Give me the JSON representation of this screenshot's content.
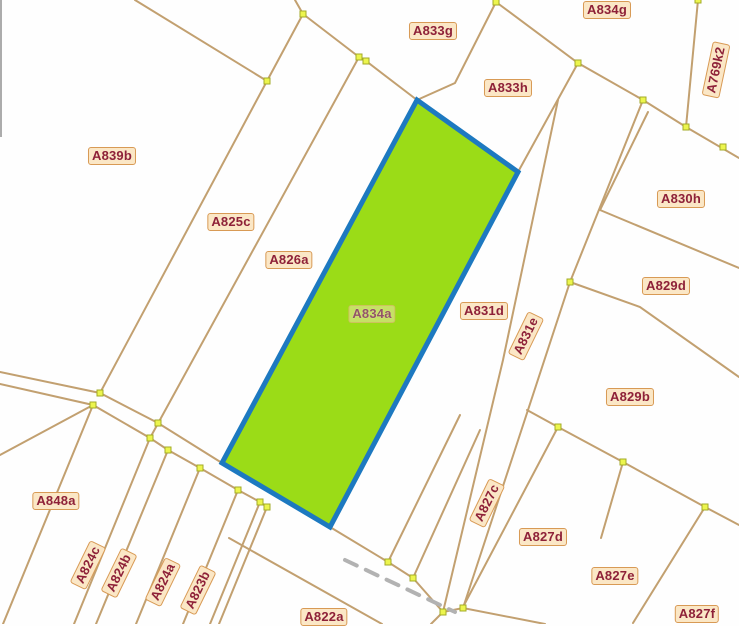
{
  "map": {
    "width": 739,
    "height": 624,
    "background_color": "#fefefe",
    "boundary_line_color": "#c2a070",
    "boundary_line_width": 2,
    "vertex_marker": {
      "fill": "#ecf54d",
      "stroke": "#a3ab28",
      "size": 6
    },
    "label_style": {
      "text_color": "#8e2138",
      "plate_color": "#fbe7c6",
      "plate_border_color": "#d89a55"
    },
    "highlighted_parcel": {
      "label": "A834a",
      "fill_color": "#9bdc17",
      "border_color": "#1d79c0",
      "border_width": 5,
      "points": [
        [
          417,
          100
        ],
        [
          518,
          172
        ],
        [
          330,
          527
        ],
        [
          222,
          463
        ]
      ]
    },
    "edge_artifact": {
      "points": [
        [
          1,
          0
        ],
        [
          1,
          137
        ]
      ],
      "color": "#909090",
      "width": 1.5
    },
    "watermark_dash": {
      "points": [
        [
          345,
          560
        ],
        [
          455,
          612
        ]
      ],
      "color": "#b2b2b2",
      "width": 4,
      "dash": "13 10"
    },
    "boundary_lines": [
      [
        [
          135,
          0
        ],
        [
          267,
          81
        ]
      ],
      [
        [
          295,
          0
        ],
        [
          303,
          14
        ]
      ],
      [
        [
          303,
          14
        ],
        [
          267,
          81
        ]
      ],
      [
        [
          303,
          14
        ],
        [
          359,
          57
        ]
      ],
      [
        [
          267,
          81
        ],
        [
          100,
          393
        ]
      ],
      [
        [
          359,
          57
        ],
        [
          150,
          438
        ]
      ],
      [
        [
          359,
          57
        ],
        [
          366,
          61
        ],
        [
          417,
          100
        ]
      ],
      [
        [
          496,
          2
        ],
        [
          455,
          83
        ],
        [
          417,
          100
        ]
      ],
      [
        [
          496,
          2
        ],
        [
          578,
          63
        ],
        [
          643,
          100
        ],
        [
          686,
          127
        ],
        [
          739,
          158
        ]
      ],
      [
        [
          698,
          0
        ],
        [
          686,
          127
        ]
      ],
      [
        [
          578,
          63
        ],
        [
          518,
          172
        ]
      ],
      [
        [
          558,
          100
        ],
        [
          503,
          360
        ],
        [
          443,
          612
        ]
      ],
      [
        [
          643,
          100
        ],
        [
          570,
          282
        ],
        [
          463,
          608
        ]
      ],
      [
        [
          648,
          112
        ],
        [
          600,
          210
        ]
      ],
      [
        [
          600,
          210
        ],
        [
          739,
          268
        ]
      ],
      [
        [
          570,
          282
        ],
        [
          640,
          307
        ],
        [
          739,
          377
        ]
      ],
      [
        [
          527,
          410
        ],
        [
          558,
          427
        ]
      ],
      [
        [
          558,
          427
        ],
        [
          623,
          462
        ],
        [
          705,
          507
        ],
        [
          739,
          525
        ]
      ],
      [
        [
          623,
          462
        ],
        [
          601,
          538
        ]
      ],
      [
        [
          558,
          427
        ],
        [
          463,
          607
        ]
      ],
      [
        [
          705,
          507
        ],
        [
          633,
          623
        ]
      ],
      [
        [
          0,
          372
        ],
        [
          100,
          393
        ],
        [
          158,
          423
        ],
        [
          222,
          463
        ]
      ],
      [
        [
          330,
          527
        ],
        [
          388,
          562
        ],
        [
          413,
          578
        ],
        [
          443,
          612
        ]
      ],
      [
        [
          443,
          612
        ],
        [
          463,
          608
        ],
        [
          545,
          624
        ]
      ],
      [
        [
          0,
          384
        ],
        [
          93,
          405
        ],
        [
          150,
          438
        ],
        [
          168,
          450
        ],
        [
          200,
          468
        ],
        [
          238,
          490
        ],
        [
          260,
          502
        ],
        [
          267,
          507
        ]
      ],
      [
        [
          229,
          538
        ],
        [
          382,
          624
        ]
      ],
      [
        [
          93,
          405
        ],
        [
          3,
          624
        ]
      ],
      [
        [
          150,
          438
        ],
        [
          74,
          624
        ]
      ],
      [
        [
          168,
          450
        ],
        [
          96,
          624
        ]
      ],
      [
        [
          200,
          468
        ],
        [
          136,
          624
        ]
      ],
      [
        [
          238,
          490
        ],
        [
          183,
          624
        ]
      ],
      [
        [
          260,
          502
        ],
        [
          210,
          624
        ]
      ],
      [
        [
          267,
          507
        ],
        [
          219,
          624
        ]
      ],
      [
        [
          443,
          612
        ],
        [
          431,
          624
        ]
      ],
      [
        [
          0,
          455
        ],
        [
          93,
          405
        ]
      ],
      [
        [
          388,
          562
        ],
        [
          460,
          415
        ]
      ],
      [
        [
          413,
          578
        ],
        [
          480,
          430
        ]
      ]
    ],
    "vertex_markers": [
      [
        303,
        14
      ],
      [
        267,
        81
      ],
      [
        359,
        57
      ],
      [
        366,
        61
      ],
      [
        496,
        2
      ],
      [
        578,
        63
      ],
      [
        643,
        100
      ],
      [
        686,
        127
      ],
      [
        698,
        0
      ],
      [
        723,
        147
      ],
      [
        570,
        282
      ],
      [
        558,
        427
      ],
      [
        623,
        462
      ],
      [
        705,
        507
      ],
      [
        100,
        393
      ],
      [
        93,
        405
      ],
      [
        158,
        423
      ],
      [
        150,
        438
      ],
      [
        168,
        450
      ],
      [
        200,
        468
      ],
      [
        238,
        490
      ],
      [
        260,
        502
      ],
      [
        267,
        507
      ],
      [
        388,
        562
      ],
      [
        413,
        578
      ],
      [
        443,
        612
      ],
      [
        463,
        608
      ]
    ],
    "labels": [
      {
        "text": "A833g",
        "x": 433,
        "y": 31,
        "rot": 0
      },
      {
        "text": "A834g",
        "x": 607,
        "y": 10,
        "rot": 0
      },
      {
        "text": "A833h",
        "x": 508,
        "y": 88,
        "rot": 0
      },
      {
        "text": "A769k2",
        "x": 716,
        "y": 70,
        "rot": -78
      },
      {
        "text": "A839b",
        "x": 112,
        "y": 156,
        "rot": 0
      },
      {
        "text": "A825c",
        "x": 231,
        "y": 222,
        "rot": 0
      },
      {
        "text": "A826a",
        "x": 289,
        "y": 260,
        "rot": 0
      },
      {
        "text": "A830h",
        "x": 681,
        "y": 199,
        "rot": 0
      },
      {
        "text": "A829d",
        "x": 666,
        "y": 286,
        "rot": 0
      },
      {
        "text": "A831d",
        "x": 484,
        "y": 311,
        "rot": 0
      },
      {
        "text": "A831e",
        "x": 526,
        "y": 336,
        "rot": -64
      },
      {
        "text": "A834a",
        "x": 372,
        "y": 314,
        "rot": 0,
        "ghost": true
      },
      {
        "text": "A829b",
        "x": 630,
        "y": 397,
        "rot": 0
      },
      {
        "text": "A848a",
        "x": 56,
        "y": 501,
        "rot": 0
      },
      {
        "text": "A824c",
        "x": 88,
        "y": 565,
        "rot": -64
      },
      {
        "text": "A824b",
        "x": 119,
        "y": 573,
        "rot": -64
      },
      {
        "text": "A824a",
        "x": 163,
        "y": 582,
        "rot": -64
      },
      {
        "text": "A823b",
        "x": 198,
        "y": 590,
        "rot": -64
      },
      {
        "text": "A827c",
        "x": 487,
        "y": 503,
        "rot": -64
      },
      {
        "text": "A827d",
        "x": 543,
        "y": 537,
        "rot": 0
      },
      {
        "text": "A827e",
        "x": 615,
        "y": 576,
        "rot": 0
      },
      {
        "text": "A827f",
        "x": 697,
        "y": 614,
        "rot": 0
      },
      {
        "text": "A822a",
        "x": 324,
        "y": 617,
        "rot": 0
      }
    ]
  }
}
